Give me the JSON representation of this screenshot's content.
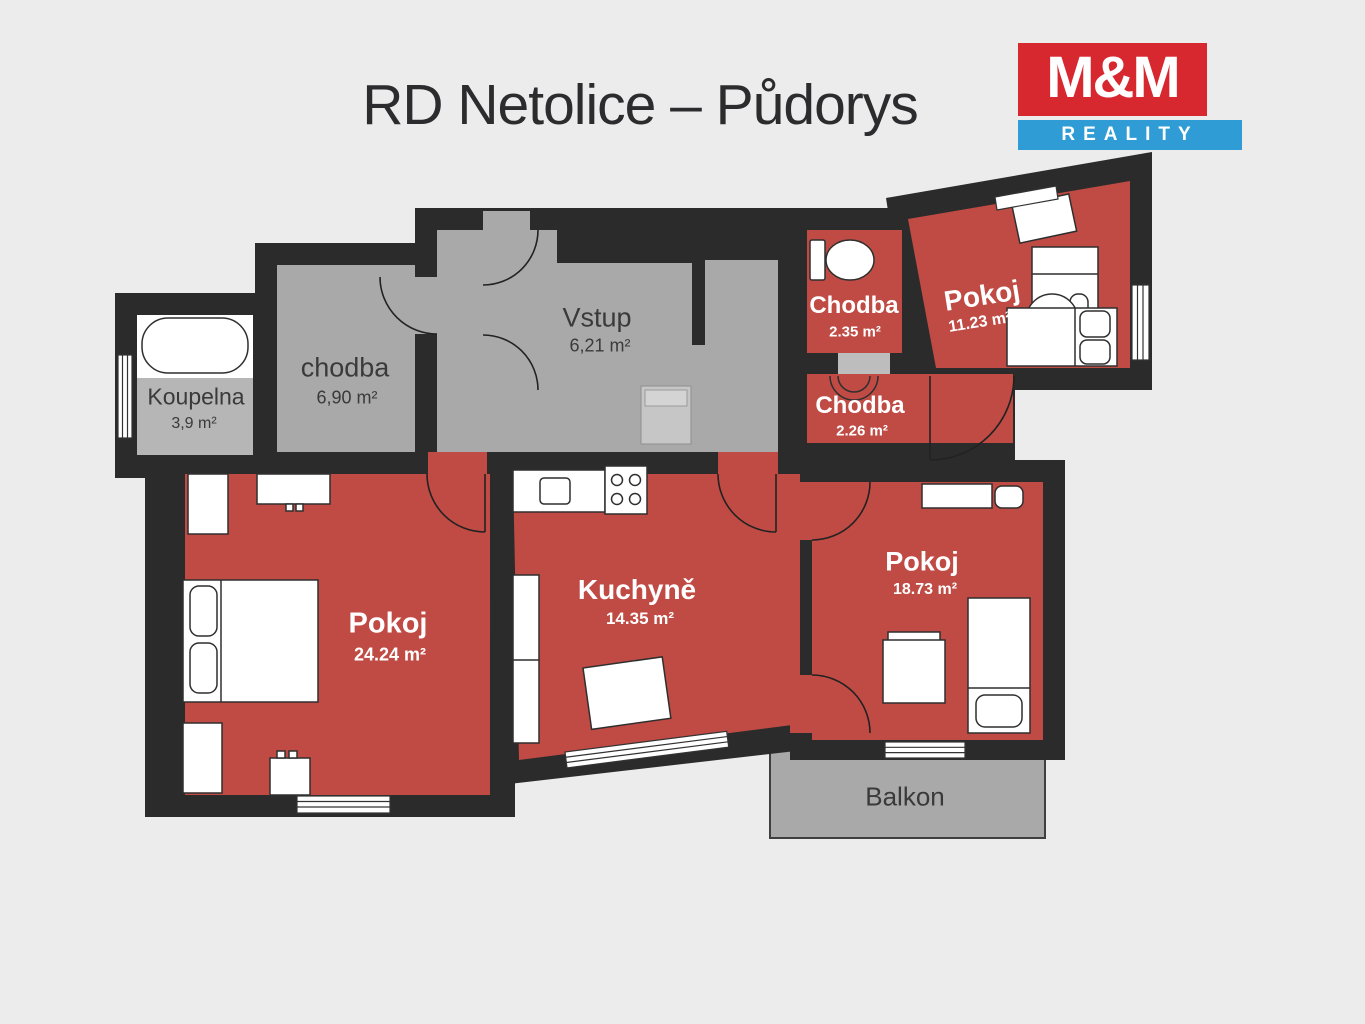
{
  "title": "RD Netolice – Půdorys",
  "logo": {
    "top": "M&M",
    "bottom": "REALITY"
  },
  "colors": {
    "background": "#ececec",
    "wall": "#2b2b2b",
    "room_red": "#c04b44",
    "room_gray": "#a9a9a9",
    "room_gray_light": "#b6b6b6",
    "balcony_gray": "#a9a9a9",
    "logo_red": "#d7282f",
    "logo_blue": "#2f9cd6",
    "label_light": "#ffffff",
    "label_dark": "#3a3a3a"
  },
  "rooms": [
    {
      "id": "koupelna",
      "name": "Koupelna",
      "area": "3,9 m²"
    },
    {
      "id": "chodba",
      "name": "chodba",
      "area": "6,90 m²"
    },
    {
      "id": "vstup",
      "name": "Vstup",
      "area": "6,21 m²"
    },
    {
      "id": "chodba-235",
      "name": "Chodba",
      "area": "2.35 m²"
    },
    {
      "id": "pokoj-1123",
      "name": "Pokoj",
      "area": "11.23 m²"
    },
    {
      "id": "chodba-226",
      "name": "Chodba",
      "area": "2.26 m²"
    },
    {
      "id": "pokoj-2424",
      "name": "Pokoj",
      "area": "24.24 m²"
    },
    {
      "id": "kuchyne",
      "name": "Kuchyně",
      "area": "14.35 m²"
    },
    {
      "id": "pokoj-1873",
      "name": "Pokoj",
      "area": "18.73 m²"
    },
    {
      "id": "balkon",
      "name": "Balkon",
      "area": ""
    }
  ]
}
